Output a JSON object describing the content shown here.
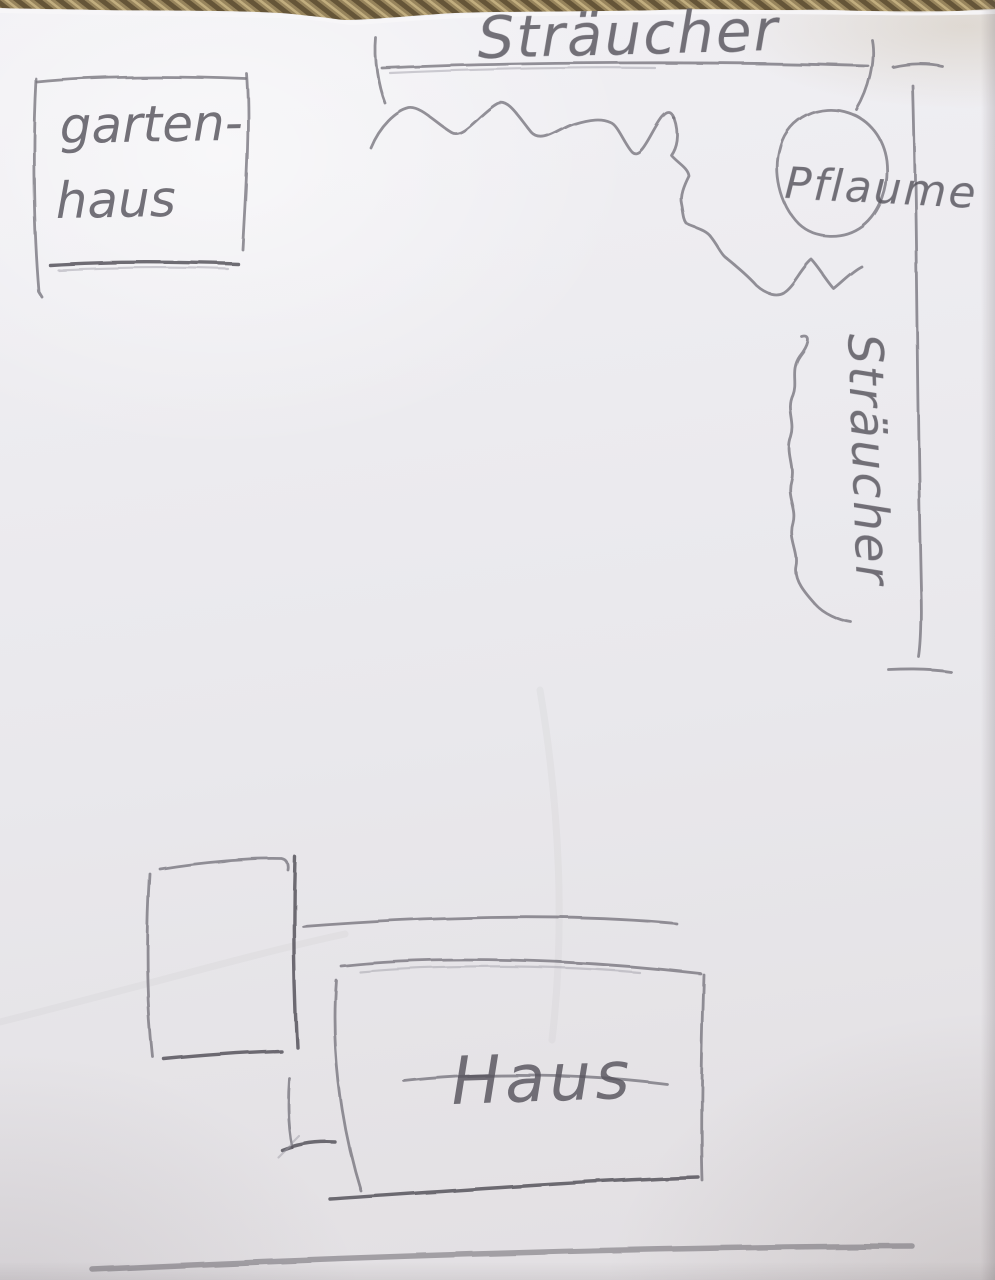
{
  "sketch": {
    "labels": {
      "shrubs_top": "Sträucher",
      "garden_house_line1": "garten-",
      "garden_house_line2": "haus",
      "plum": "Pflaume",
      "shrubs_right": "Sträucher",
      "house": "Haus"
    },
    "colors": {
      "pencil": "#76737c",
      "pencil_dark": "#56535c",
      "pencil_soft": "#9a97a1",
      "weave_base": "#97845c",
      "weave_dark": "#655538",
      "weave_light": "#c2ae7f"
    }
  }
}
